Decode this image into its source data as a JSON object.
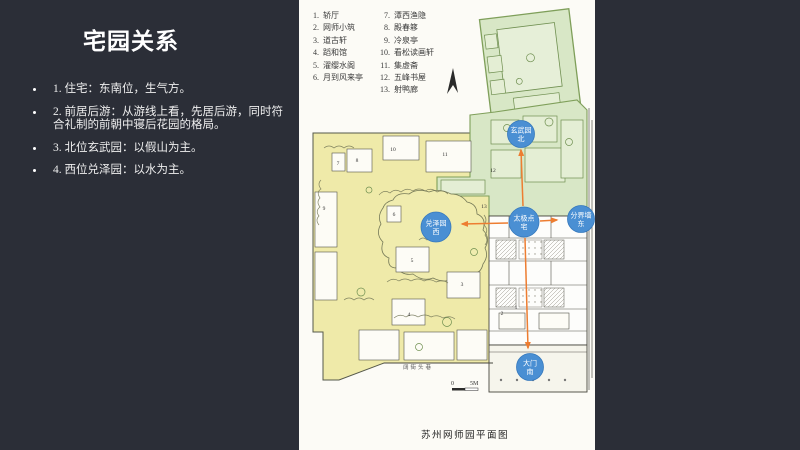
{
  "slide": {
    "title": "宅园关系",
    "bullets": [
      "1. 住宅：东南位，生气方。",
      "2. 前居后游：从游线上看，先居后游，同时符合礼制的前朝中寝后花园的格局。",
      "3. 北位玄武园：以假山为主。",
      "4. 西位兑泽园：以水为主。"
    ]
  },
  "map": {
    "caption": "苏州网师园平面图",
    "street_label": "阔街头巷",
    "scale": {
      "zero": "0",
      "five": "5M"
    },
    "legend": {
      "col1": [
        {
          "n": "1.",
          "label": "轿厅"
        },
        {
          "n": "2.",
          "label": "网师小筑"
        },
        {
          "n": "3.",
          "label": "道古轩"
        },
        {
          "n": "4.",
          "label": "蹈和馆"
        },
        {
          "n": "5.",
          "label": "濯缨水阁"
        },
        {
          "n": "6.",
          "label": "月到风来亭"
        }
      ],
      "col2": [
        {
          "n": "7.",
          "label": "潭西渔隐"
        },
        {
          "n": "8.",
          "label": "殿春簃"
        },
        {
          "n": "9.",
          "label": "冷泉亭"
        },
        {
          "n": "10.",
          "label": "看松读画轩"
        },
        {
          "n": "11.",
          "label": "集虚斋"
        },
        {
          "n": "12.",
          "label": "五峰书屋"
        },
        {
          "n": "13.",
          "label": "射鸭廊"
        }
      ]
    },
    "badges": [
      {
        "id": "north-garden",
        "lines": [
          "玄武园",
          "北"
        ],
        "x": 222,
        "y": 134,
        "r": 13.5
      },
      {
        "id": "west-garden",
        "lines": [
          "兑泽园",
          "西"
        ],
        "x": 137,
        "y": 227,
        "r": 15
      },
      {
        "id": "taiji-residence",
        "lines": [
          "太极点",
          "宅"
        ],
        "x": 225,
        "y": 222,
        "r": 15
      },
      {
        "id": "boundary-wall-east",
        "lines": [
          "分界墙",
          "东"
        ],
        "x": 282,
        "y": 219,
        "r": 13.5
      },
      {
        "id": "main-gate-south",
        "lines": [
          "大门",
          "南"
        ],
        "x": 231,
        "y": 367,
        "r": 13.5
      }
    ],
    "arrows": [
      {
        "x1": 224,
        "y1": 206,
        "x2": 222,
        "y2": 150
      },
      {
        "x1": 209,
        "y1": 223,
        "x2": 163,
        "y2": 224
      },
      {
        "x1": 241,
        "y1": 221,
        "x2": 258,
        "y2": 220
      },
      {
        "x1": 226,
        "y1": 238,
        "x2": 229,
        "y2": 348
      }
    ],
    "plan_numbers": [
      {
        "t": "1",
        "x": 217,
        "y": 309
      },
      {
        "t": "2",
        "x": 203,
        "y": 315
      },
      {
        "t": "3",
        "x": 163,
        "y": 286
      },
      {
        "t": "4",
        "x": 110,
        "y": 316
      },
      {
        "t": "5",
        "x": 113,
        "y": 262
      },
      {
        "t": "6",
        "x": 95,
        "y": 216
      },
      {
        "t": "7",
        "x": 39,
        "y": 165
      },
      {
        "t": "8",
        "x": 58,
        "y": 162
      },
      {
        "t": "9",
        "x": 25,
        "y": 210
      },
      {
        "t": "10",
        "x": 94,
        "y": 151
      },
      {
        "t": "11",
        "x": 146,
        "y": 156
      },
      {
        "t": "12",
        "x": 194,
        "y": 172
      },
      {
        "t": "13",
        "x": 185,
        "y": 208
      }
    ],
    "colors": {
      "west_garden_fill": "#efeaa9",
      "north_garden_fill": "#d8e7c6",
      "badge_fill": "#4a8fd3",
      "badge_stroke": "#3679bd",
      "arrow": "#ed7d31",
      "panel_bg": "#fcfbf6",
      "slide_bg": "#2b2e37"
    }
  }
}
